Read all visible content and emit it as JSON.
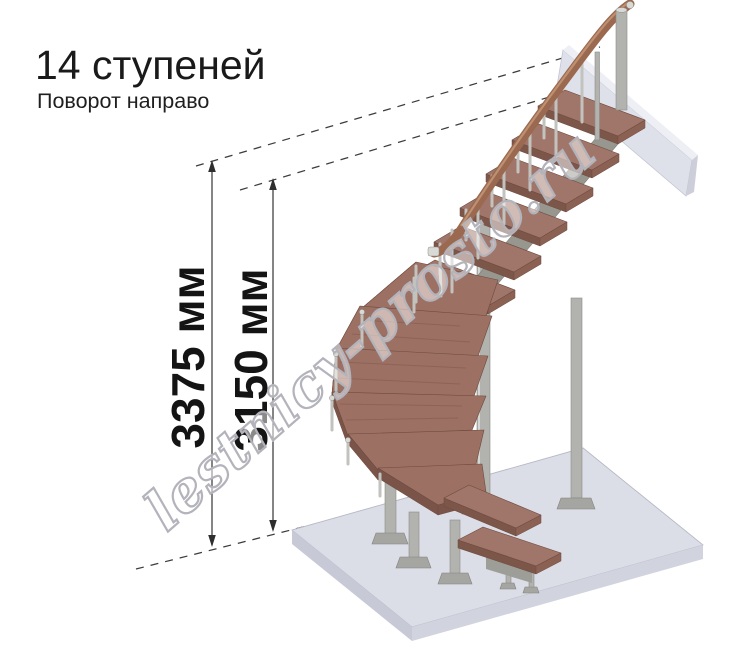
{
  "header": {
    "title": "14 ступеней",
    "subtitle": "Поворот направо"
  },
  "dimensions": [
    {
      "label": "3375 мм"
    },
    {
      "label": "3150 мм"
    }
  ],
  "watermark": "lestnicy-prosto.ru",
  "illustration": {
    "subject": "Модульная лестница, 14 ступеней, поворот направо",
    "steps_count": 14,
    "colors": {
      "tread_wood": "#a1766a",
      "tread_wood_dark": "#7d564a",
      "handrail": "#9a6950",
      "handrail_highlight": "#c49877",
      "metal": "#b2b2ae",
      "floor_slab": "#dbdde7",
      "landing_slab": "#dfe1ea",
      "dimension_line": "#3c3c3c",
      "watermark_outline": "#b3b3bb"
    }
  }
}
